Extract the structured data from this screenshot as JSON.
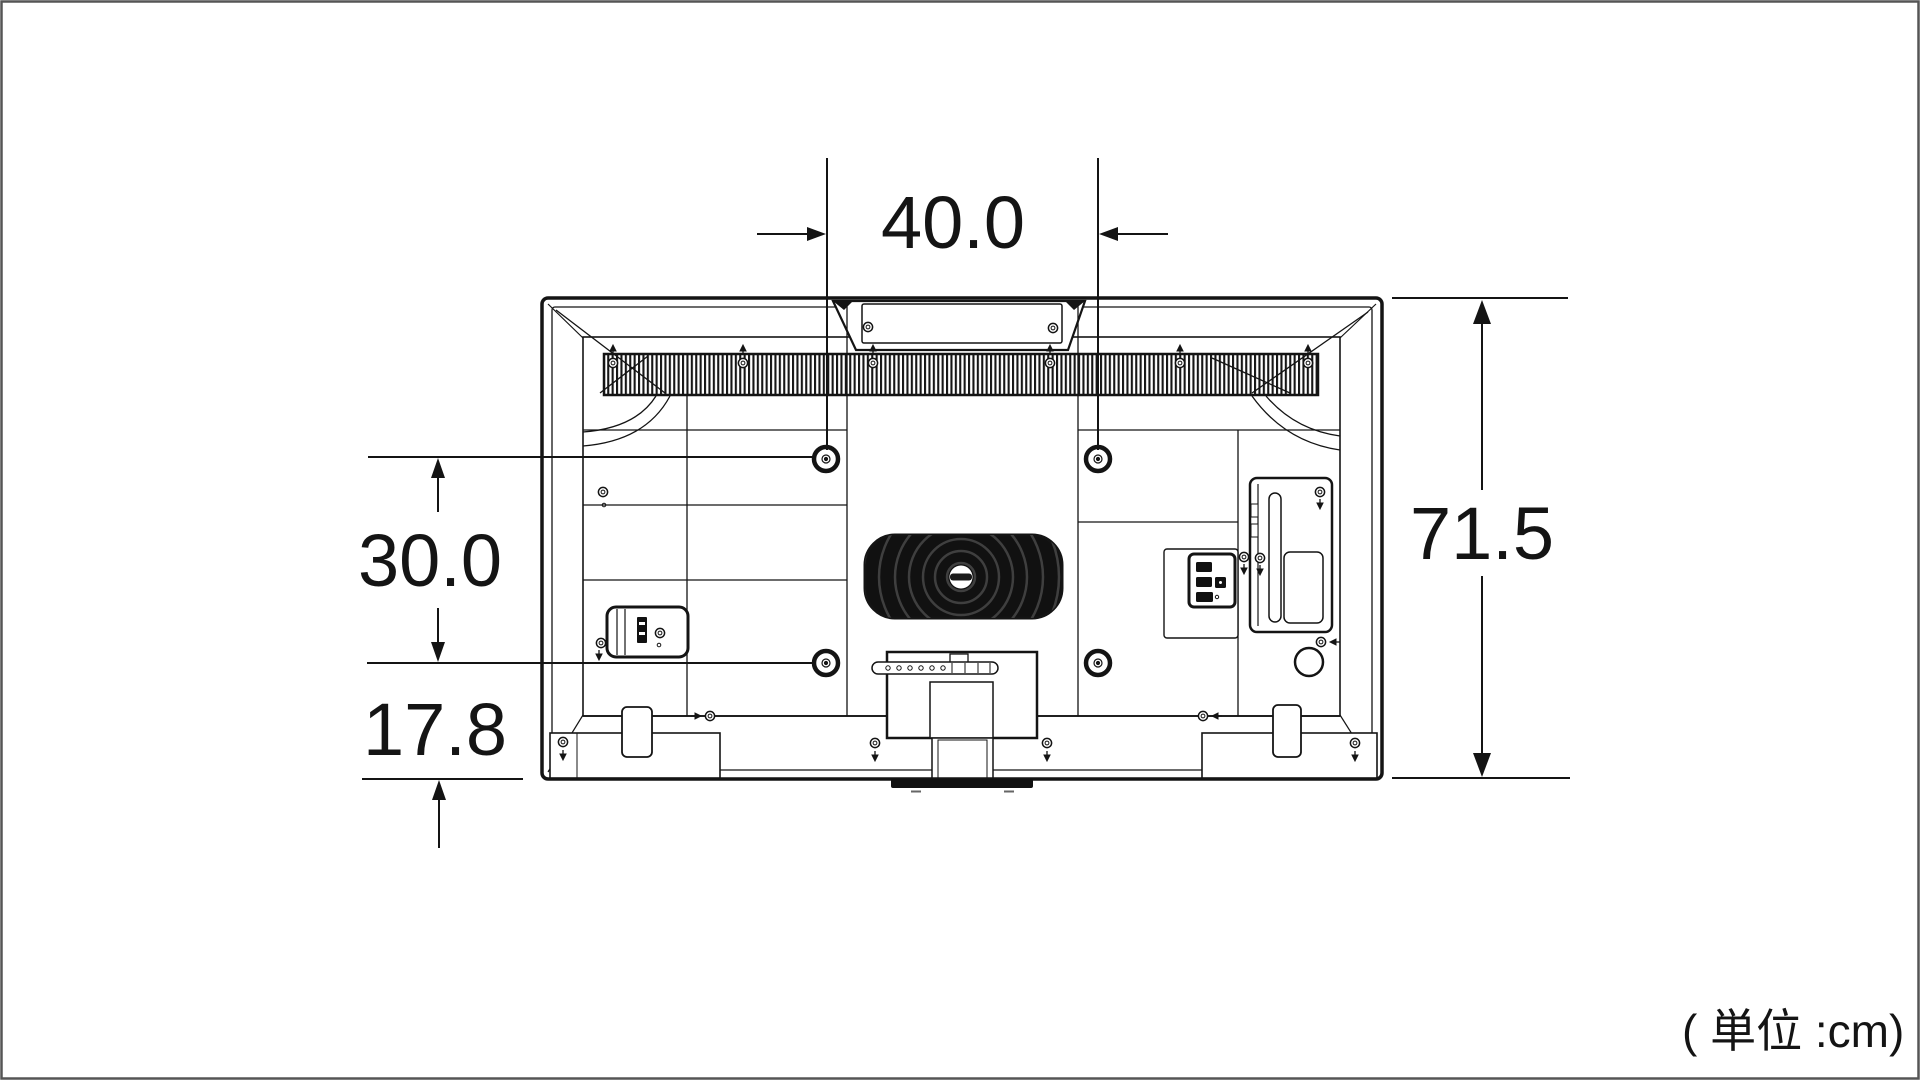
{
  "canvas": {
    "background": "#ffffff",
    "border_color": "#555555",
    "line_color": "#141414"
  },
  "unit_label": "( 単位 :cm)",
  "dimensions": {
    "mount_width": {
      "label": "40.0",
      "value_cm": 40.0,
      "orientation": "horizontal"
    },
    "mount_height": {
      "label": "30.0",
      "value_cm": 30.0,
      "orientation": "vertical"
    },
    "mount_bottom_offset": {
      "label": "17.8",
      "value_cm": 17.8,
      "orientation": "vertical"
    },
    "set_height": {
      "label": "71.5",
      "value_cm": 71.5,
      "orientation": "vertical"
    }
  }
}
